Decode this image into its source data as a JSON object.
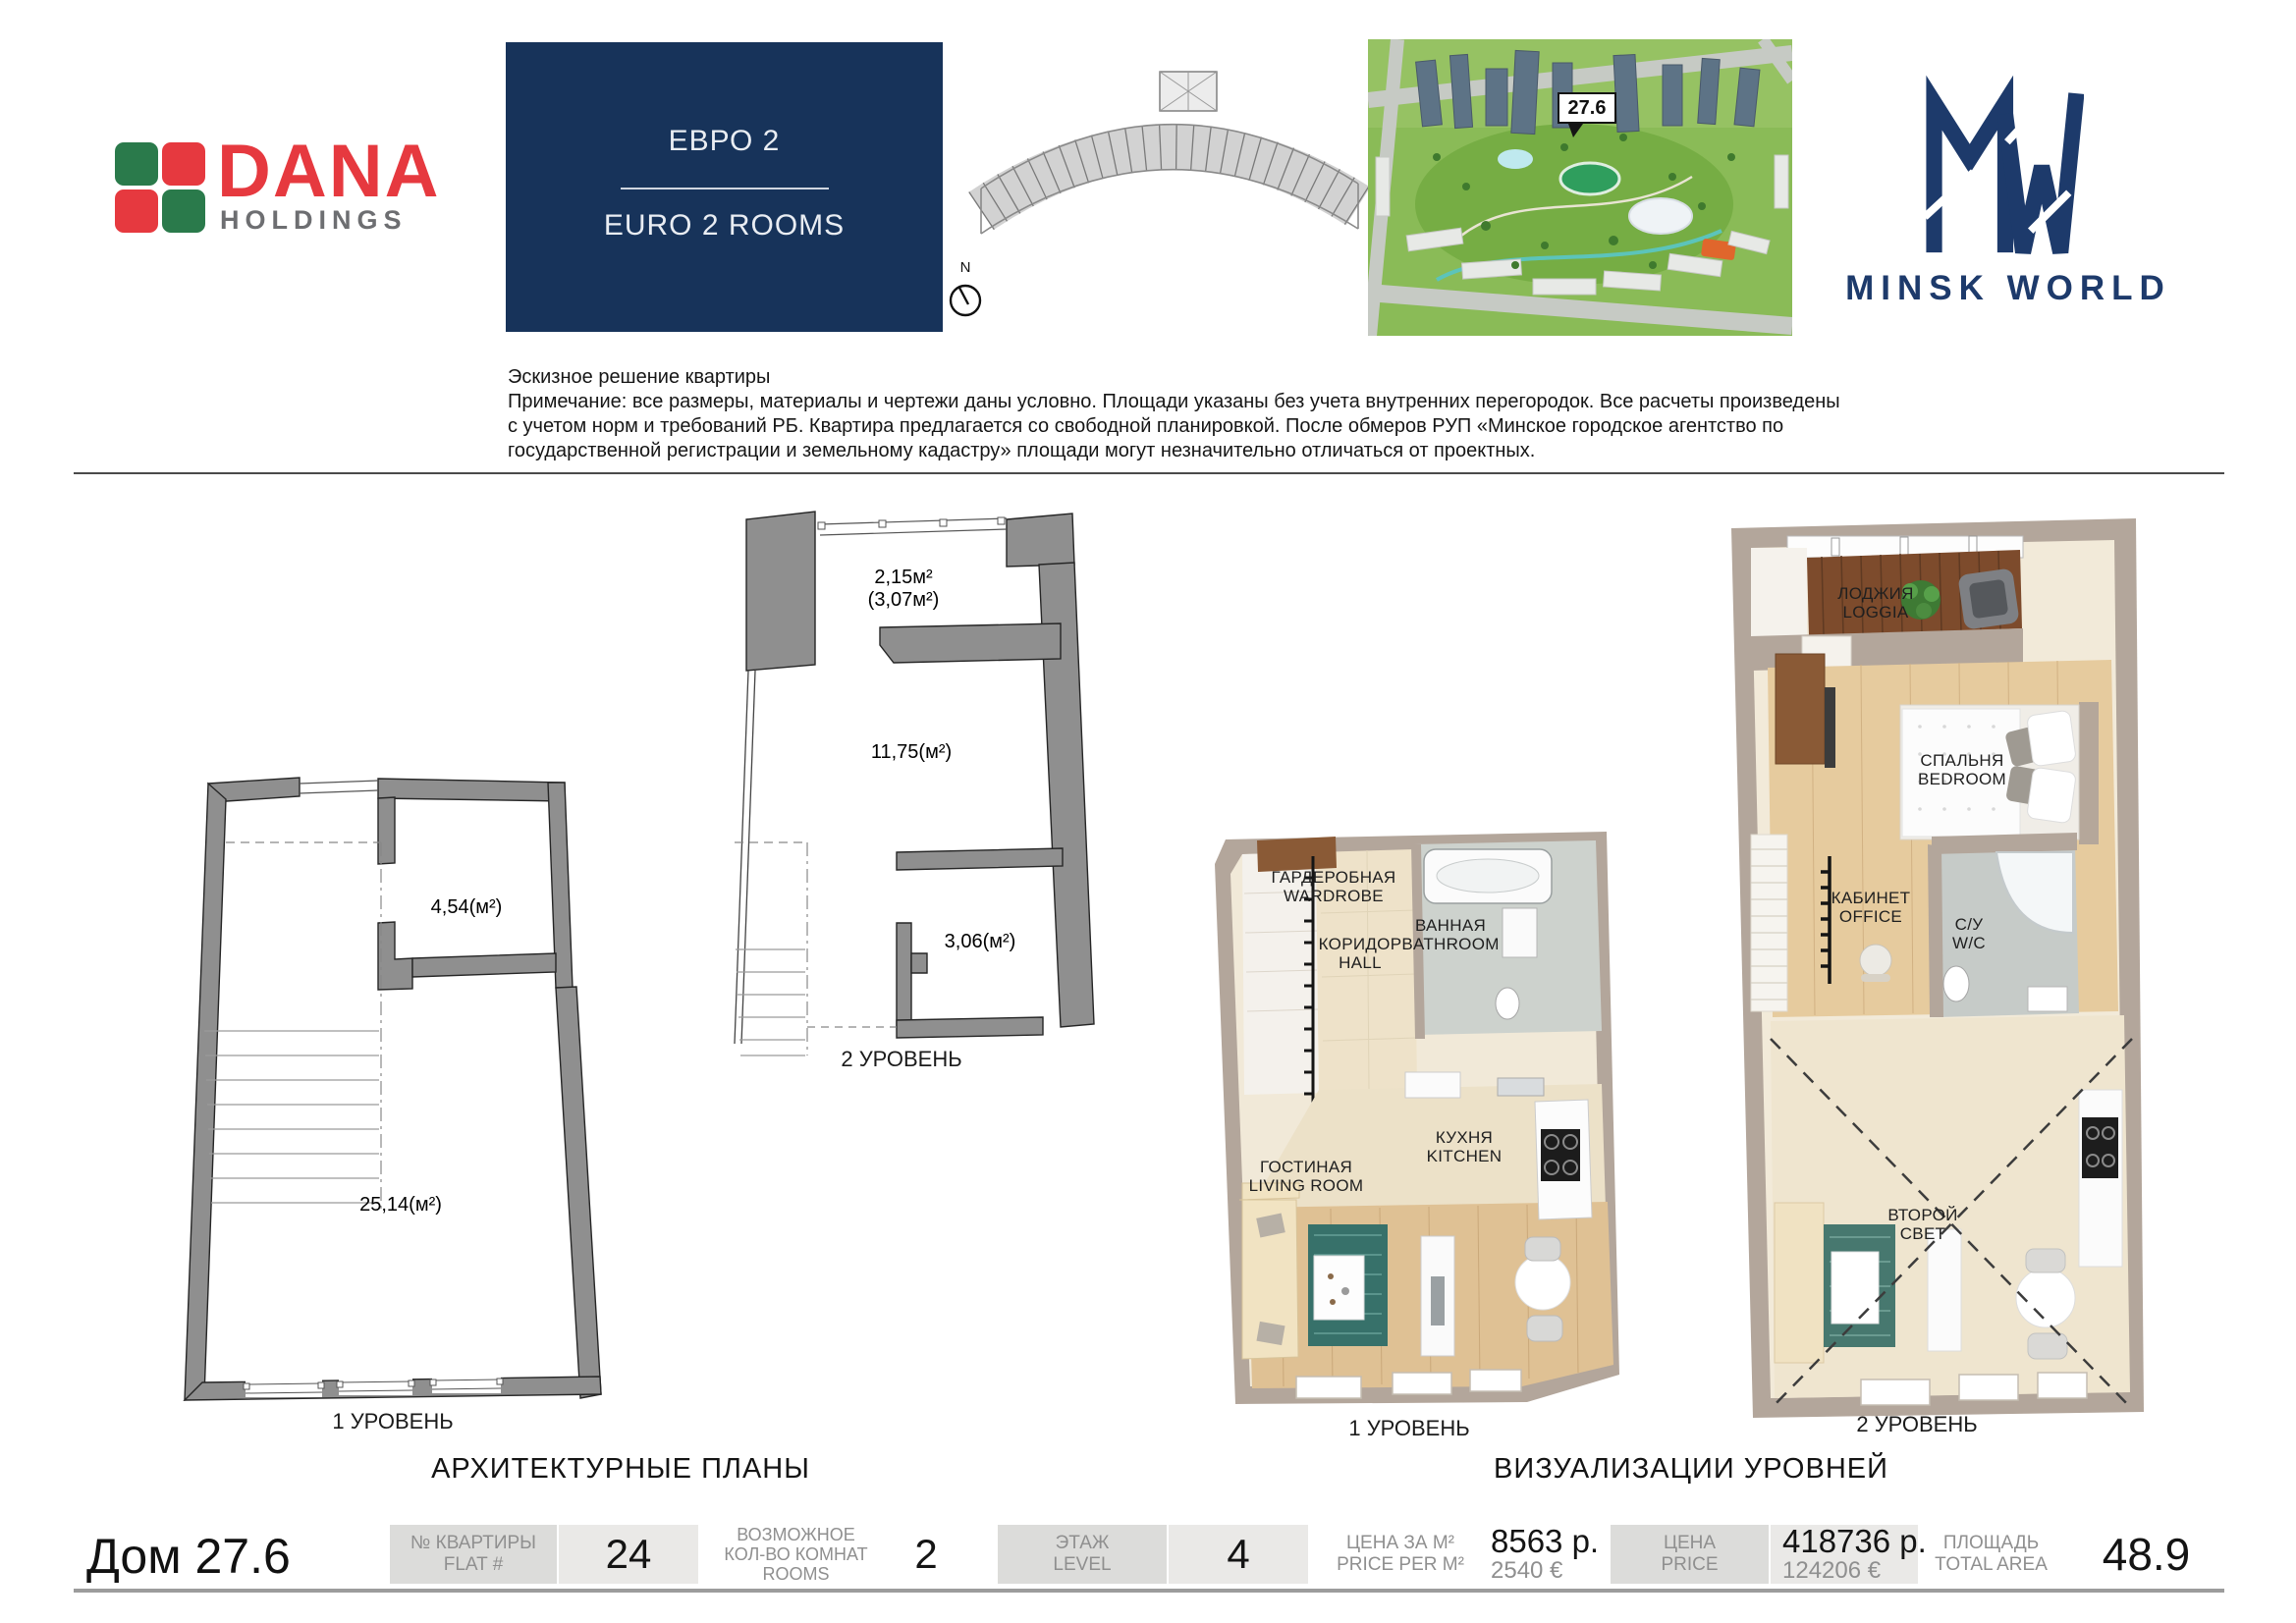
{
  "header": {
    "dana": {
      "word1": "DANA",
      "word2": "HOLDINGS"
    },
    "title_box": {
      "ru": "ЕВРО 2",
      "en": "EURO 2 ROOMS"
    },
    "compass": "N",
    "aerial_callout": "27.6",
    "minsk_world": "MINSK WORLD"
  },
  "disclaimer": {
    "line1": "Эскизное решение квартиры",
    "line2": "Примечание: все размеры, материалы и чертежи даны условно. Площади указаны без учета внутренних перегородок. Все расчеты произведены",
    "line3": "с учетом норм и требований РБ. Квартира предлагается со свободной планировкой. После обмеров РУП «Минское городское агентство по",
    "line4": "государственной регистрации и земельному кадастру» площади могут незначительно отличаться от проектных."
  },
  "plans": {
    "section_title": "АРХИТЕКТУРНЫЕ ПЛАНЫ",
    "level1": {
      "caption": "1 УРОВЕНЬ",
      "area_wardrobe": "4,54(м²)",
      "area_living": "25,14(м²)"
    },
    "level2": {
      "caption": "2 УРОВЕНЬ",
      "area_balcony": "2,15м²",
      "area_balcony_alt": "(3,07м²)",
      "area_room": "11,75(м²)",
      "area_wc": "3,06(м²)"
    }
  },
  "viz": {
    "section_title": "ВИЗУАЛИЗАЦИИ УРОВНЕЙ",
    "level1": {
      "caption": "1 УРОВЕНЬ",
      "wardrobe": {
        "l1": "ГАРДЕРОБНАЯ",
        "l2": "WARDROBE"
      },
      "bathroom": {
        "l1": "ВАННАЯ",
        "l2": "BATHROOM"
      },
      "hall": {
        "l1": "КОРИДОР",
        "l2": "HALL"
      },
      "kitchen": {
        "l1": "КУХНЯ",
        "l2": "KITCHEN"
      },
      "living": {
        "l1": "ГОСТИНАЯ",
        "l2": "LIVING ROOM"
      }
    },
    "level2": {
      "caption": "2 УРОВЕНЬ",
      "loggia": {
        "l1": "ЛОДЖИЯ",
        "l2": "LOGGIA"
      },
      "bedroom": {
        "l1": "СПАЛЬНЯ",
        "l2": "BEDROOM"
      },
      "office": {
        "l1": "КАБИНЕТ",
        "l2": "OFFICE"
      },
      "wc": {
        "l1": "С/У",
        "l2": "W/C"
      },
      "void": {
        "l1": "ВТОРОЙ",
        "l2": "СВЕТ"
      }
    }
  },
  "footer": {
    "house": "Дом 27.6",
    "flat": {
      "label1": "№ КВАРТИРЫ",
      "label2": "FLAT #",
      "value": "24"
    },
    "rooms": {
      "label1": "ВОЗМОЖНОЕ",
      "label2": "КОЛ-ВО КОМНАТ",
      "label3": "ROOMS",
      "value": "2"
    },
    "level": {
      "label1": "ЭТАЖ",
      "label2": "LEVEL",
      "value": "4"
    },
    "price_m2": {
      "label1": "ЦЕНА ЗА М²",
      "label2": "PRICE PER M²",
      "byn": "8563 р.",
      "eur": "2540 €"
    },
    "price": {
      "label1": "ЦЕНА",
      "label2": "PRICE",
      "byn": "418736 р.",
      "eur": "124206 €"
    },
    "area": {
      "label1": "ПЛОЩАДЬ",
      "label2": "TOTAL AREA",
      "value": "48.9"
    }
  },
  "colors": {
    "navy_box": "#17335a",
    "logo_navy": "#1d3a6b",
    "dana_red": "#e6393f",
    "dana_green": "#2a7a4b",
    "wall_gray": "#8f8f8f",
    "taupe_wall": "#b3a69b"
  }
}
